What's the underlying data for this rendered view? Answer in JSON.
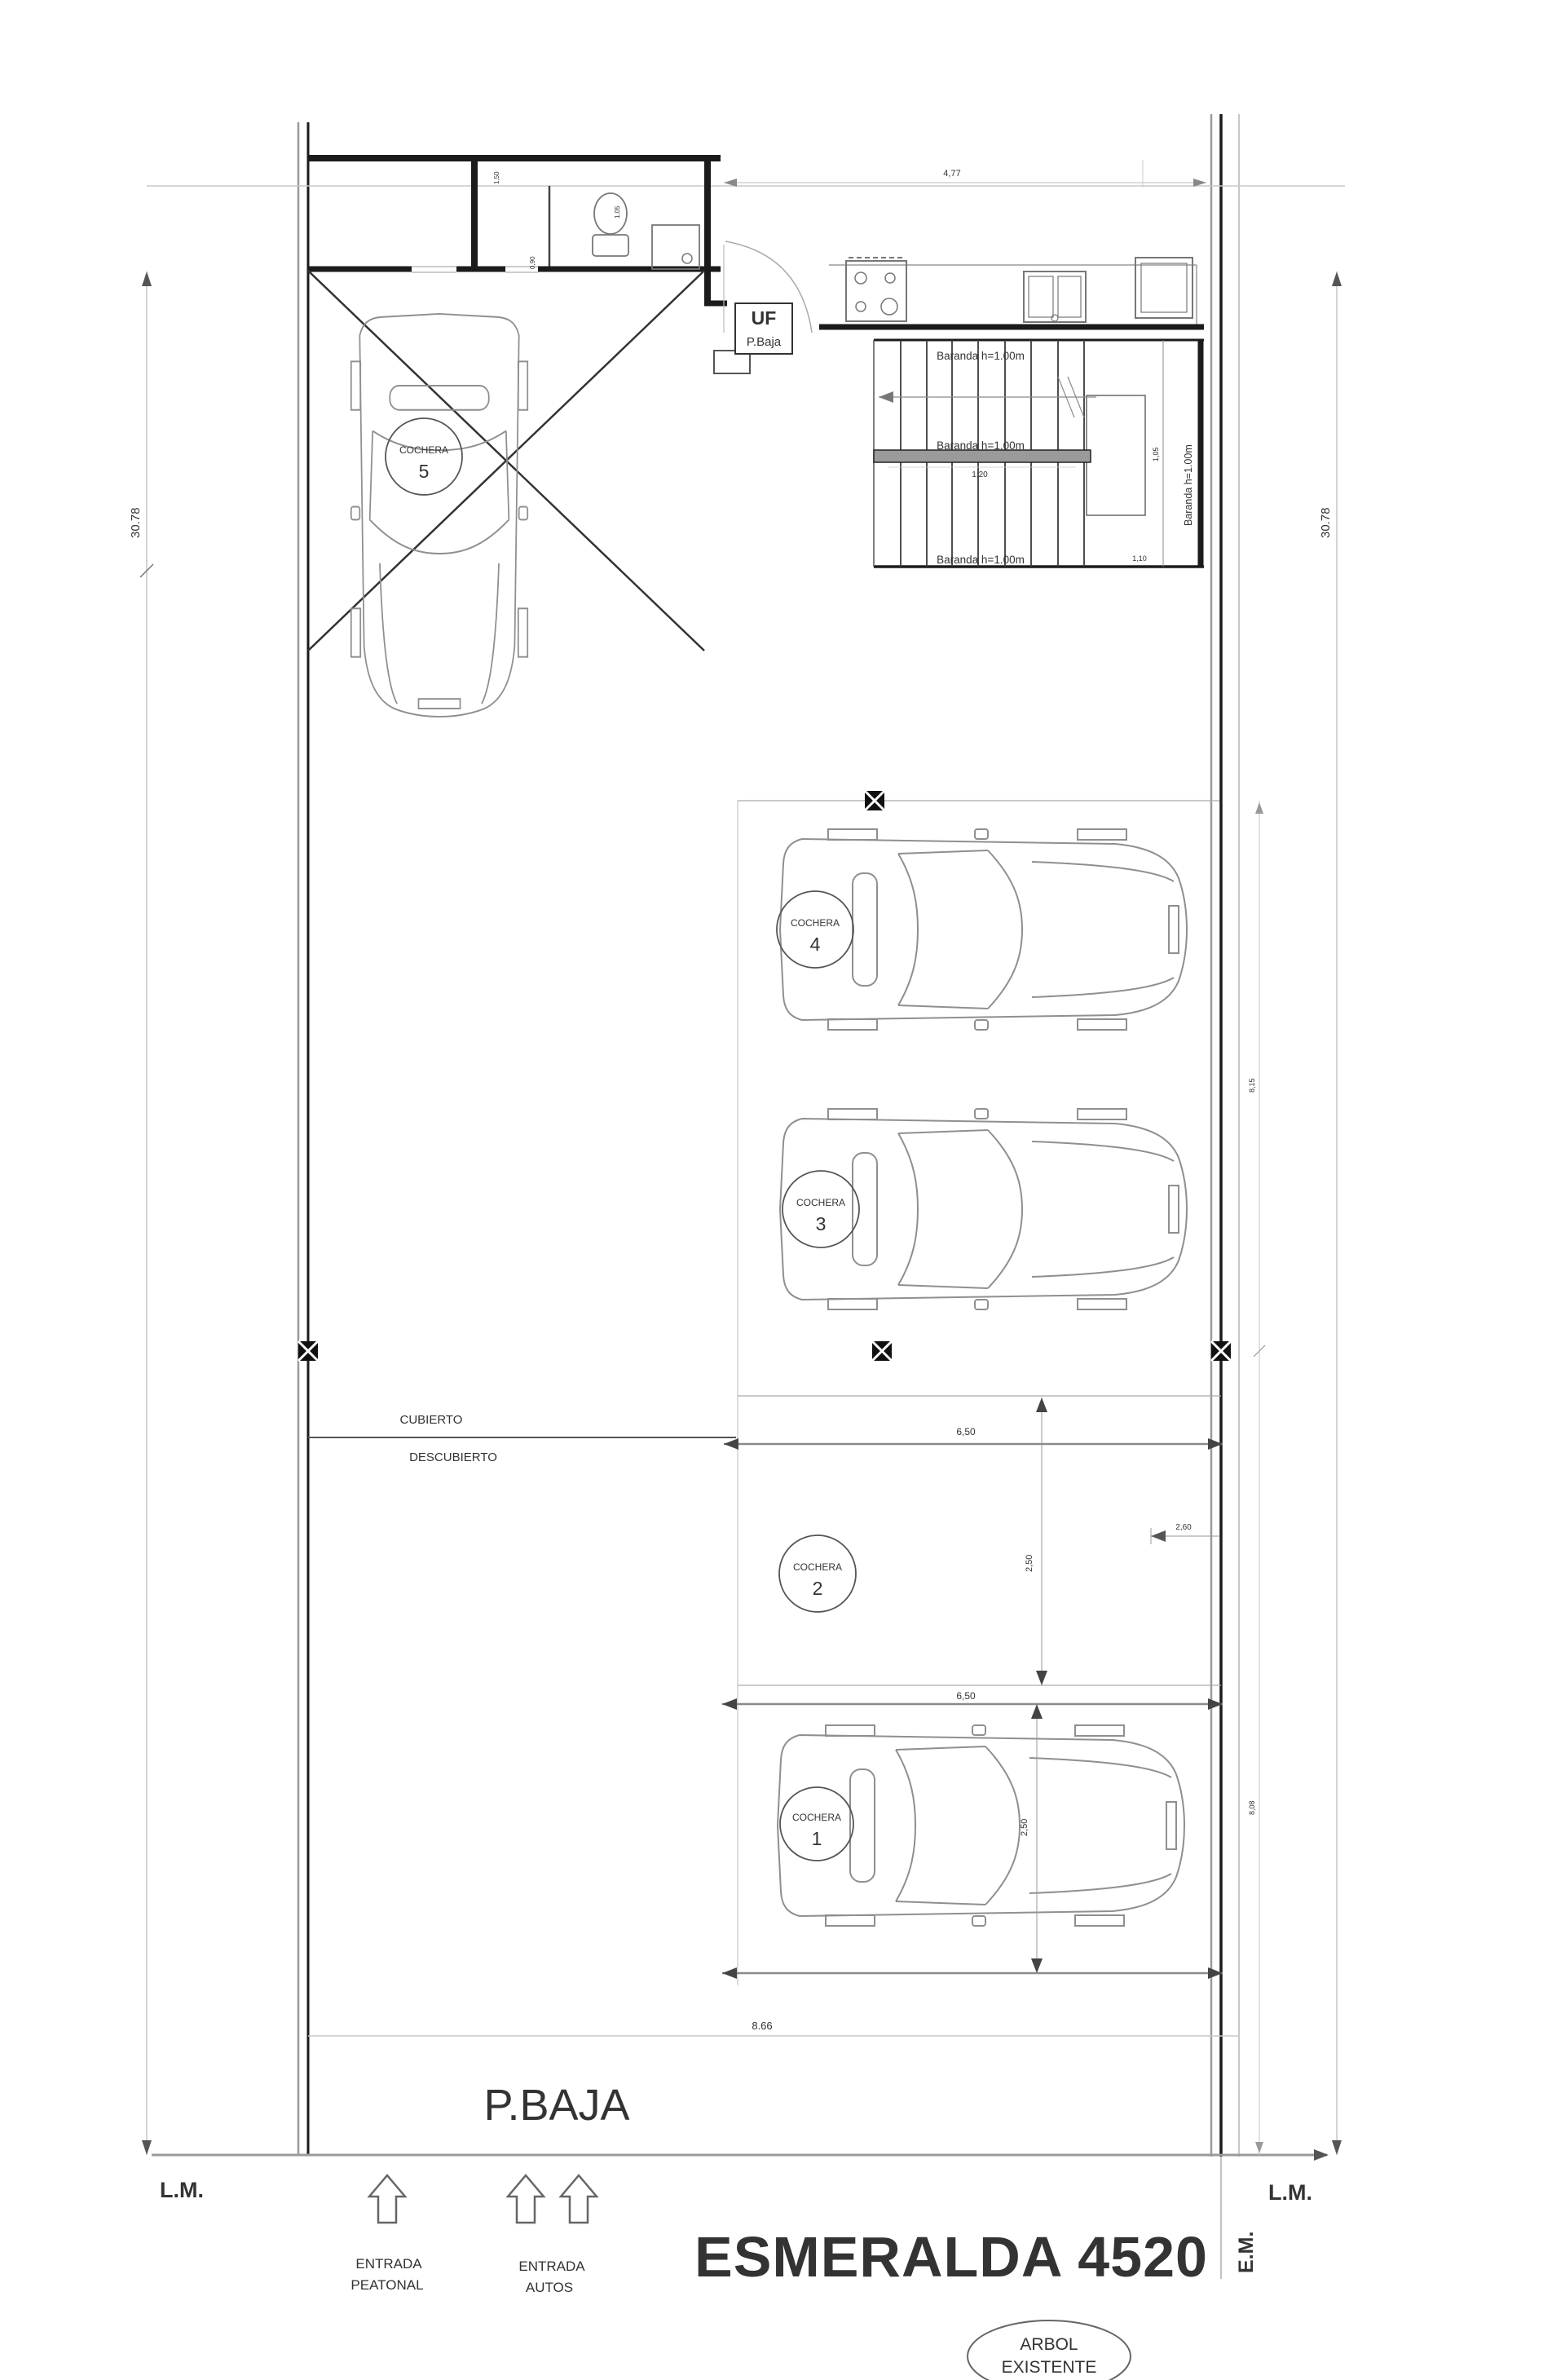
{
  "title": {
    "street": "ESMERALDA 4520",
    "floor": "P.BAJA"
  },
  "unit_box": {
    "line1": "UF",
    "line2": "P.Baja"
  },
  "labels": {
    "cubierto": "CUBIERTO",
    "descubierto": "DESCUBIERTO",
    "lm_left": "L.M.",
    "lm_right": "L.M.",
    "em": "E.M.",
    "entrada_peatonal_l1": "ENTRADA",
    "entrada_peatonal_l2": "PEATONAL",
    "entrada_autos_l1": "ENTRADA",
    "entrada_autos_l2": "AUTOS",
    "arbol_l1": "ARBOL",
    "arbol_l2": "EXISTENTE",
    "baranda": "Baranda h=1.00m"
  },
  "cocheras": {
    "c1": {
      "title": "COCHERA",
      "num": "1"
    },
    "c2": {
      "title": "COCHERA",
      "num": "2"
    },
    "c3": {
      "title": "COCHERA",
      "num": "3"
    },
    "c4": {
      "title": "COCHERA",
      "num": "4"
    },
    "c5": {
      "title": "COCHERA",
      "num": "5"
    }
  },
  "dims": {
    "lot_depth_left": "30.78",
    "lot_depth_right": "30.78",
    "front_width": "8.66",
    "top_width": "4,77",
    "bay2_width": "6,50",
    "bay2_depth": "2,50",
    "bay2_offset": "2,60",
    "bay1_width": "6,50",
    "bay1_depth": "2,50",
    "stair_run": "1,20",
    "stair_landing": "1,10",
    "stair_side": "1,05",
    "right_segment_upper": "8,15",
    "right_segment_lower": "8,08",
    "room_tiny_a": "1,50",
    "room_tiny_b": "1,05",
    "room_tiny_c": "0,90"
  }
}
